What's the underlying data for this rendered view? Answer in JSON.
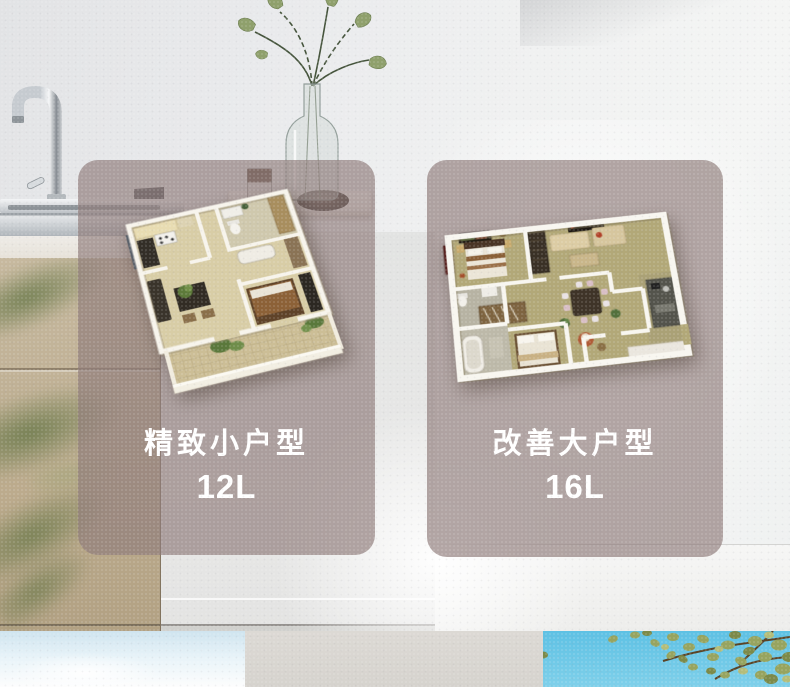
{
  "cards": [
    {
      "title": "精致小户型",
      "capacity": "12L"
    },
    {
      "title": "改善大户型",
      "capacity": "16L"
    }
  ],
  "colors": {
    "card_overlay": "rgba(143,124,122,0.68)",
    "label_text": "#ffffff",
    "sky_blue": "#5ec1e4",
    "tree_foliage": "#94a25d",
    "cabinet_tan": "#c0b196",
    "small_plan_floor": "#d8cda6",
    "large_plan_floor": "#b2a878"
  }
}
